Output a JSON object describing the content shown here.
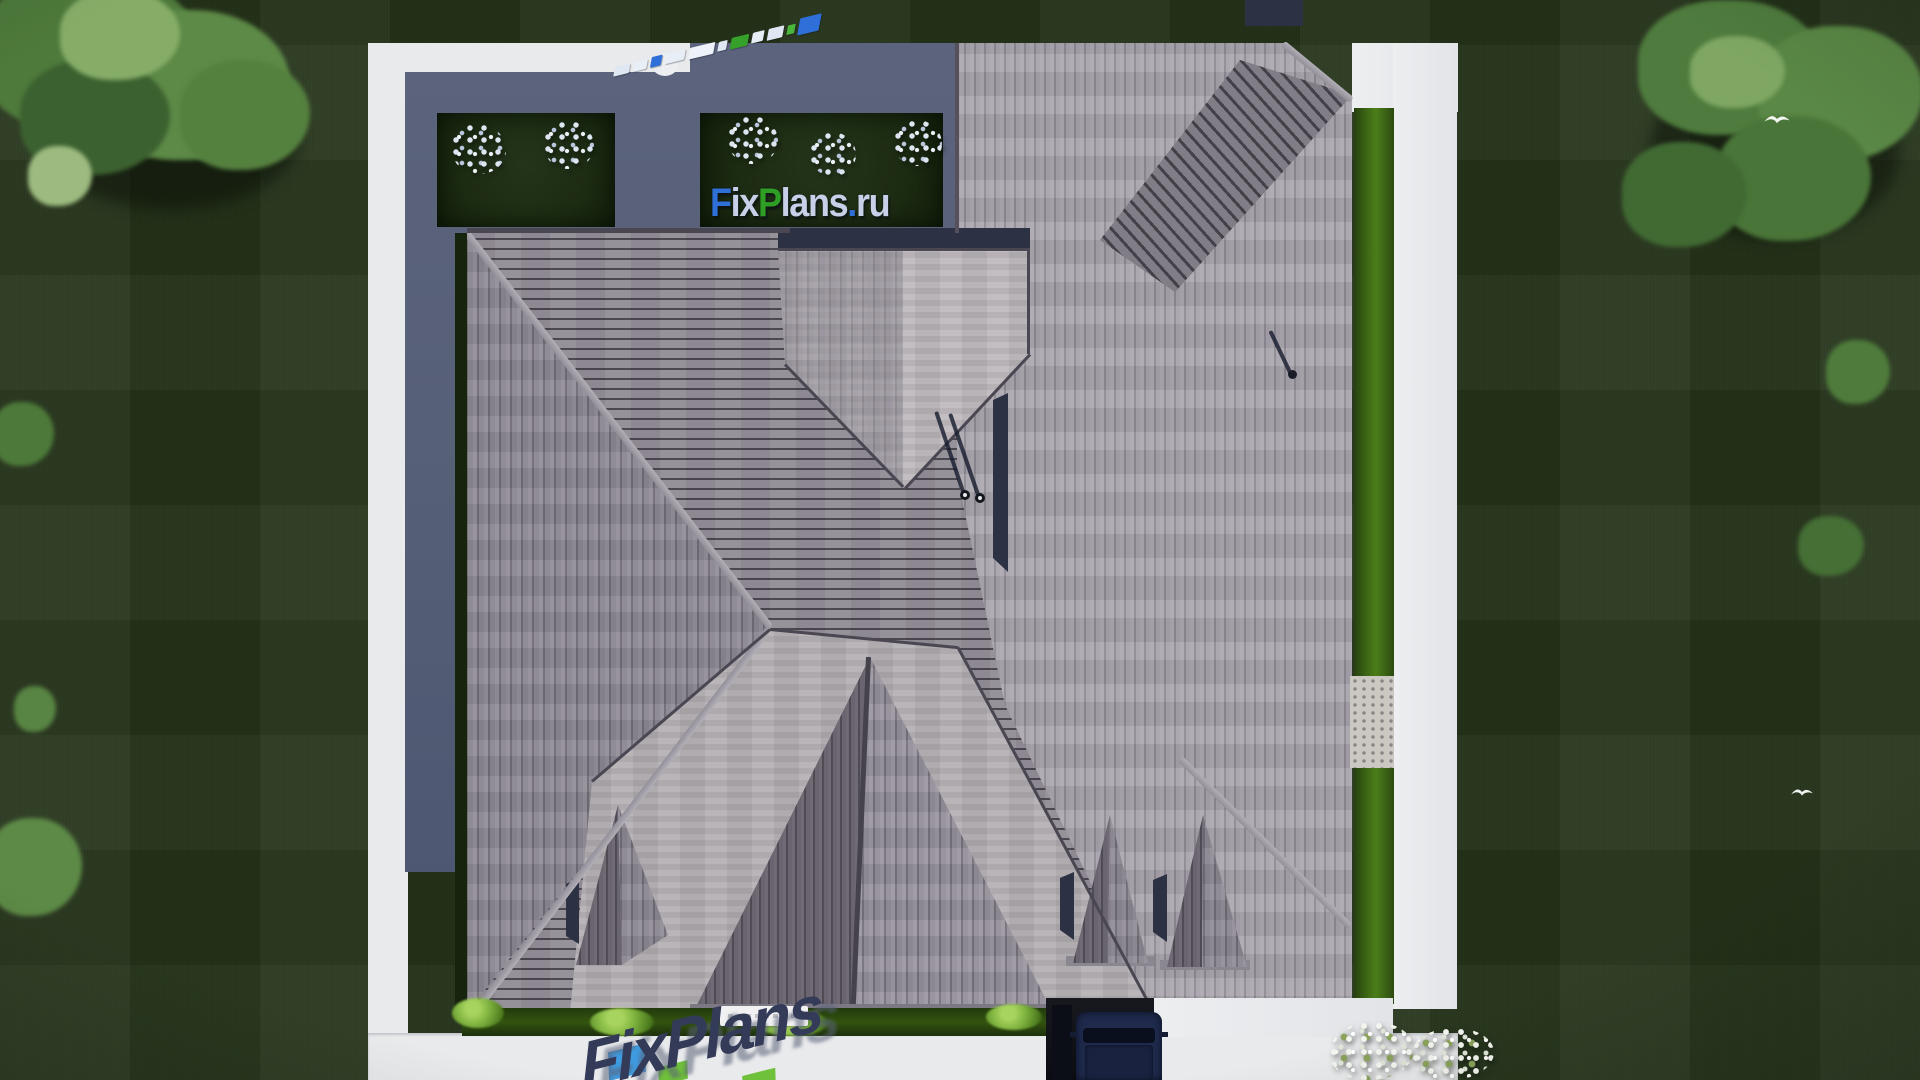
{
  "scene": {
    "description": "Aerial top-down 3D render of a house with gray hip roof, lawn, white walkways and trees",
    "site": "FixPlans.ru"
  },
  "brand": {
    "name": "FixPlans.ru",
    "segments": [
      {
        "t": "F",
        "c": "#2f6fd8"
      },
      {
        "t": "ix",
        "c": "#c7d0e8"
      },
      {
        "t": "P",
        "c": "#2f9e25"
      },
      {
        "t": "lans",
        "c": "#c7d0e8"
      },
      {
        "t": ".",
        "c": "#2f6fd8"
      },
      {
        "t": "ru",
        "c": "#c7d0e8"
      }
    ]
  },
  "watermark_diagonal": {
    "blocks": [
      {
        "w": 16,
        "h": 9,
        "c": "#dfe7f2"
      },
      {
        "w": 14,
        "h": 9,
        "c": "#e8eef6"
      },
      {
        "w": 11,
        "h": 10,
        "c": "#2e6fd9"
      },
      {
        "w": 20,
        "h": 10,
        "c": "#e8eef6"
      },
      {
        "w": 26,
        "h": 11,
        "c": "#eef3f9"
      },
      {
        "w": 9,
        "h": 9,
        "c": "#dfe7f2"
      },
      {
        "w": 18,
        "h": 11,
        "c": "#35a02a"
      },
      {
        "w": 12,
        "h": 10,
        "c": "#e8eef6"
      },
      {
        "w": 16,
        "h": 11,
        "c": "#dfe7f2"
      },
      {
        "w": 8,
        "h": 9,
        "c": "#49b53a"
      },
      {
        "w": 22,
        "h": 16,
        "c": "#2e6fd9"
      }
    ]
  },
  "watermark_bottom": {
    "text": "FixPlans",
    "color": "#333b58",
    "accent_blue": "#3f9be0",
    "accent_green": "#6fc03a"
  },
  "palette": {
    "lawn": "#26351b",
    "pavement": "#e9eaec",
    "courtyard_shadow": "#556077",
    "roof_mid": "#8b8690",
    "roof_light": "#a29da7",
    "roof_terrace": "#b2adb1",
    "roof_dark": "#655f6b",
    "hedge_green": "#3f6b15",
    "car_body": "#1f2a4c"
  }
}
